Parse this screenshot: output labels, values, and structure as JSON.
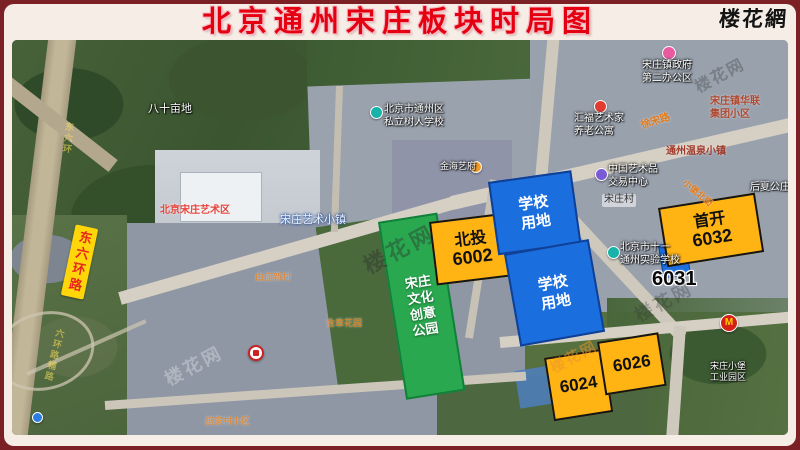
{
  "header": {
    "title": "北京通州宋庄板块时局图",
    "logo": "楼花網"
  },
  "plots": {
    "park": {
      "lines": [
        "宋庄",
        "文化",
        "创意",
        "公园"
      ]
    },
    "beitou": {
      "line1": "北投",
      "line2": "6002"
    },
    "school_north": {
      "line1": "学校",
      "line2": "用地"
    },
    "school_south": {
      "line1": "学校",
      "line2": "用地"
    },
    "shoukai": {
      "line1": "首开",
      "line2": "6032"
    },
    "lot_6024": {
      "label": "6024"
    },
    "lot_6026": {
      "label": "6026"
    },
    "lot_6031": {
      "label": "6031"
    }
  },
  "roads": {
    "liuhuan_badge": "东六环路",
    "xusong": "徐宋路",
    "xiaopu": "小堡北街",
    "liuhuan_faint": "东六环",
    "fulu_faint": "六环路辅路"
  },
  "places": {
    "bashimudi": "八十亩地",
    "shuren_line1": "北京市通州区",
    "shuren_line2": "私立树人学校",
    "jinhai": "金海艺府",
    "art_town": "宋庄艺术小镇",
    "art_district": "北京宋庄艺术区",
    "gov_line1": "宋庄镇政府",
    "gov_line2": "第二办公区",
    "huifu_line1": "汇福艺术家",
    "huifu_line2": "养老公寓",
    "hualian_line1": "宋庄镇华联",
    "hualian_line2": "集团小区",
    "wenquan": "通州温泉小镇",
    "art_exchange_line1": "中国艺术品",
    "art_exchange_line2": "交易中心",
    "houxia": "后夏公庄",
    "songzhuang_village": "宋庄村",
    "shiyan_line1": "北京市十一",
    "shiyan_line2": "通州实验学校",
    "baimiao": "白庙新村",
    "hanzhang": "含章花园",
    "huajiacun": "画家村小区",
    "industry_line1": "宋庄小堡",
    "industry_line2": "工业园区"
  },
  "watermark": "楼花网",
  "icons": {
    "mcdonalds": "M"
  },
  "colors": {
    "plot_orange": "#ffb414",
    "plot_blue": "#1a6ede",
    "plot_green": "#2aa84f",
    "title_red": "#e50011",
    "frame_maroon": "#7b2125",
    "road_badge_yellow": "#ffd60a"
  }
}
